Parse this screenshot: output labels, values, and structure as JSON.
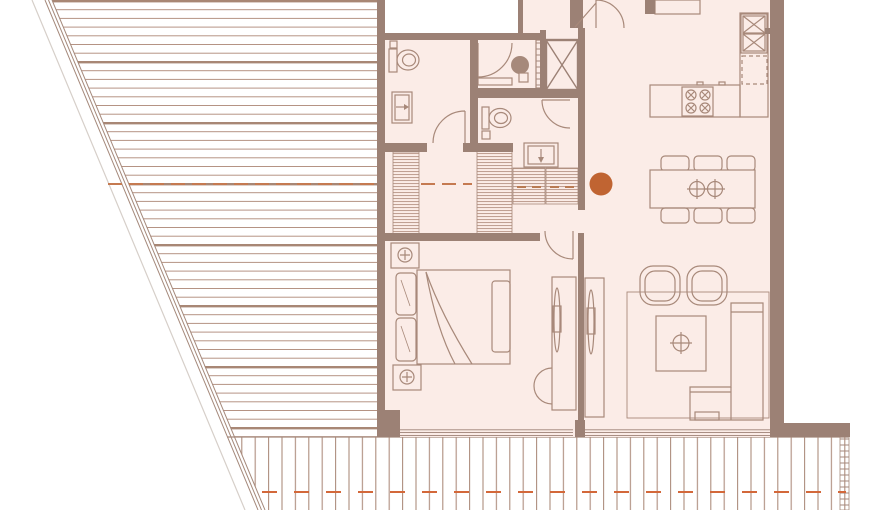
{
  "canvas": {
    "width": 880,
    "height": 510,
    "background": "#ffffff"
  },
  "colors": {
    "room_fill": "#fbece7",
    "wall": "#9c8175",
    "furniture_line": "#a8897a",
    "hatch_line": "#b59384",
    "hatch_line_strong": "#a88775",
    "deck_line": "#ad8d7e",
    "roof_dash": "#c57a51",
    "terrace_dash": "#d3683a",
    "marker": "#c06432",
    "appliance_fill": "#a6897b",
    "outer_edge": "#d6cfc9",
    "void_fill": "#ffffff"
  },
  "marker": {
    "name": "unit-location-dot",
    "cx": 601,
    "cy": 184,
    "r": 11.5
  },
  "roof": {
    "pattern": "horizontal-siding-lines",
    "hatch_spacing": 8.7,
    "centerline_y": 184
  },
  "terrace": {
    "pattern": "vertical-deck-boards",
    "deck_spacing": 13.4,
    "axis_dash_y": 492
  },
  "apartment": {
    "rooms": [
      {
        "name": "bathroom",
        "furniture": [
          "toilet",
          "vanity-sink",
          "swing-door"
        ]
      },
      {
        "name": "laundry",
        "furniture": [
          "washing-machine",
          "counter",
          "swing-door",
          "shelf-cabinet"
        ]
      },
      {
        "name": "services-shaft",
        "furniture": [
          "x-braced-shaft"
        ]
      },
      {
        "name": "wc",
        "furniture": [
          "toilet",
          "swing-door"
        ]
      },
      {
        "name": "hallway",
        "furniture": [
          "wardrobe",
          "wardrobe",
          "vanity-sink",
          "closet-with-rails"
        ]
      },
      {
        "name": "kitchen",
        "furniture": [
          "counter",
          "double-sink",
          "dishwasher",
          "island-with-cooktop"
        ]
      },
      {
        "name": "dining",
        "furniture": [
          "table-for-six",
          "chairs"
        ]
      },
      {
        "name": "living",
        "furniture": [
          "rug",
          "armchair",
          "armchair",
          "coffee-table",
          "corner-sofa",
          "tv-sideboard"
        ]
      },
      {
        "name": "bedroom",
        "furniture": [
          "double-bed",
          "nightstand",
          "nightstand",
          "tv-sideboard",
          "reading-chair",
          "swing-door"
        ]
      },
      {
        "name": "entrance",
        "furniture": [
          "entry-door"
        ]
      }
    ]
  }
}
